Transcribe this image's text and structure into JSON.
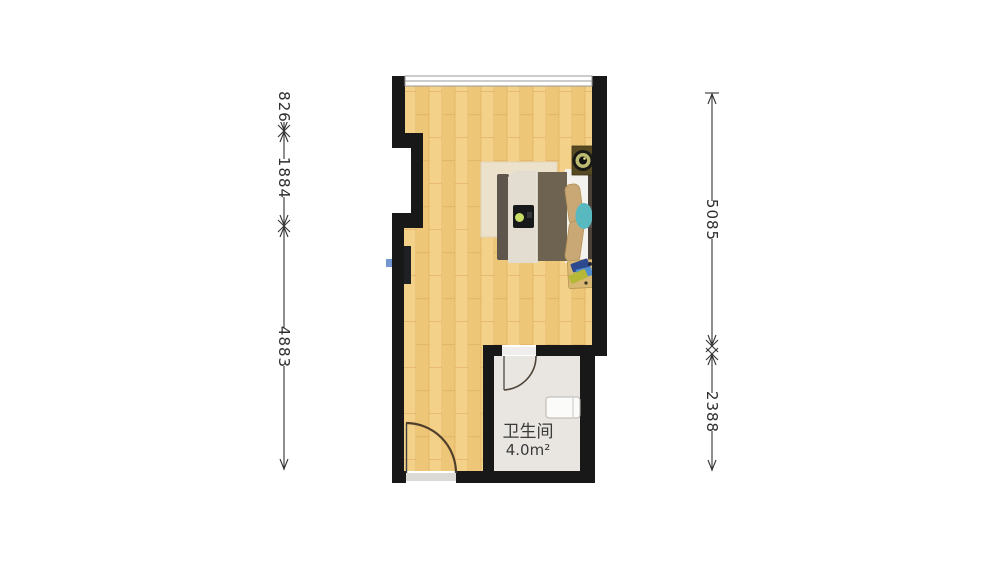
{
  "floor_plan": {
    "bathroom": {
      "label": "卫生间",
      "area": "4.0m²"
    },
    "dimensions": {
      "left": [
        "826",
        "1884",
        "4883"
      ],
      "right": [
        "5085",
        "2388"
      ]
    },
    "icons": [
      "window-icon",
      "entry-door-swing-icon",
      "bathroom-door-swing-icon",
      "double-bed-icon",
      "pillow-icon",
      "rug-icon",
      "nightstand-lamp-icon",
      "bedside-table-icon",
      "laptop-tray-icon",
      "washbasin-icon",
      "wall-switch-icon"
    ],
    "colors": {
      "wall": "#181818",
      "wood_floor": "#f3d189",
      "wood_floor_dark": "#edc677",
      "bathroom_floor": "#e9e6e2",
      "rug": "#ece2cc",
      "bed_blanket_brown": "#6e6251",
      "bed_panel_cream": "#e2ddd0",
      "mattress_white": "#f4f2ee",
      "pillow_tan": "#c9a876",
      "teal_accent": "#58b9c0",
      "door_arc_brown": "#503f2c",
      "dimension_line": "#333333"
    }
  }
}
